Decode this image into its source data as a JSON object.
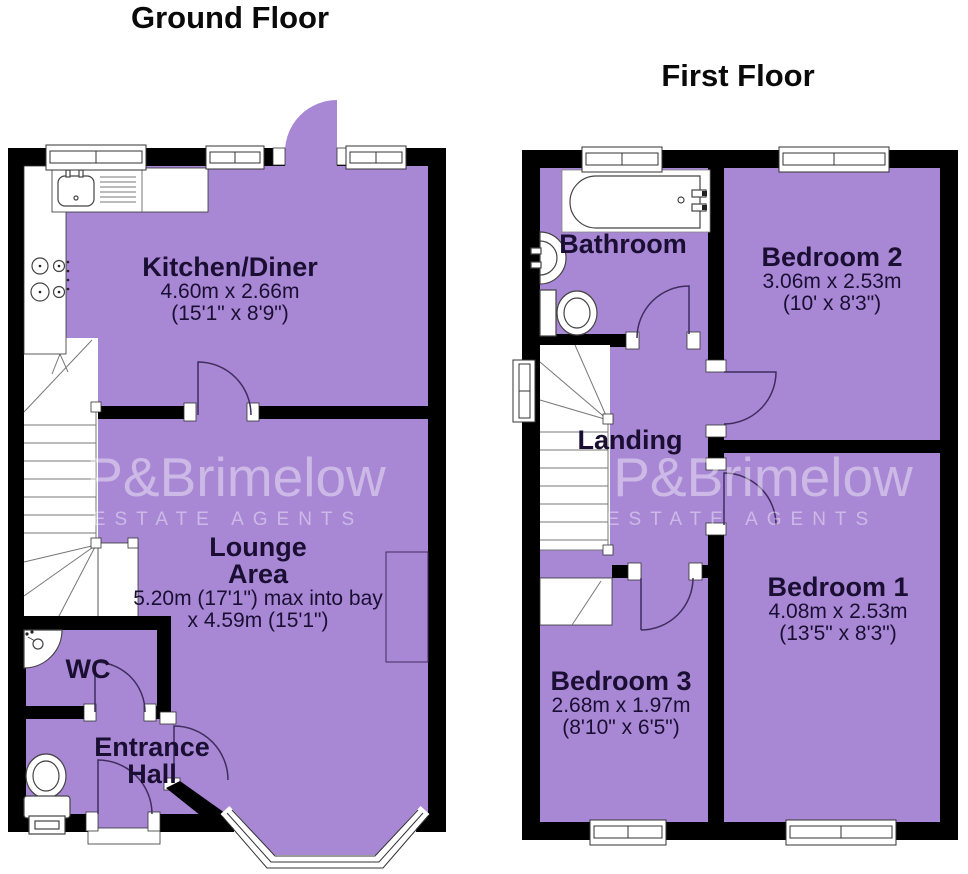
{
  "colors": {
    "room_fill": "#a887d5",
    "wall": "#000000",
    "label_text": "#1a0f33",
    "door_arc": "#3f2d5e",
    "watermark": "rgba(255,255,255,0.42)"
  },
  "watermark": {
    "brand": "P&Brimelow",
    "tagline": "ESTATE AGENTS"
  },
  "ground_floor": {
    "title": "Ground Floor",
    "rooms": {
      "kitchen": {
        "name": "Kitchen/Diner",
        "dims_metric": "4.60m x 2.66m",
        "dims_imperial": "(15'1\" x 8'9\")"
      },
      "lounge": {
        "name": "Lounge",
        "name2": "Area",
        "dims_metric": "5.20m (17'1\") max into bay",
        "dims_imperial": "x 4.59m (15'1\")"
      },
      "wc": {
        "name": "WC"
      },
      "hall": {
        "name": "Entrance",
        "name2": "Hall"
      }
    }
  },
  "first_floor": {
    "title": "First Floor",
    "rooms": {
      "bathroom": {
        "name": "Bathroom"
      },
      "bedroom2": {
        "name": "Bedroom 2",
        "dims_metric": "3.06m x 2.53m",
        "dims_imperial": "(10' x 8'3\")"
      },
      "landing": {
        "name": "Landing"
      },
      "bedroom1": {
        "name": "Bedroom 1",
        "dims_metric": "4.08m x 2.53m",
        "dims_imperial": "(13'5\" x 8'3\")"
      },
      "bedroom3": {
        "name": "Bedroom 3",
        "dims_metric": "2.68m x 1.97m",
        "dims_imperial": "(8'10\" x 6'5\")"
      }
    }
  }
}
